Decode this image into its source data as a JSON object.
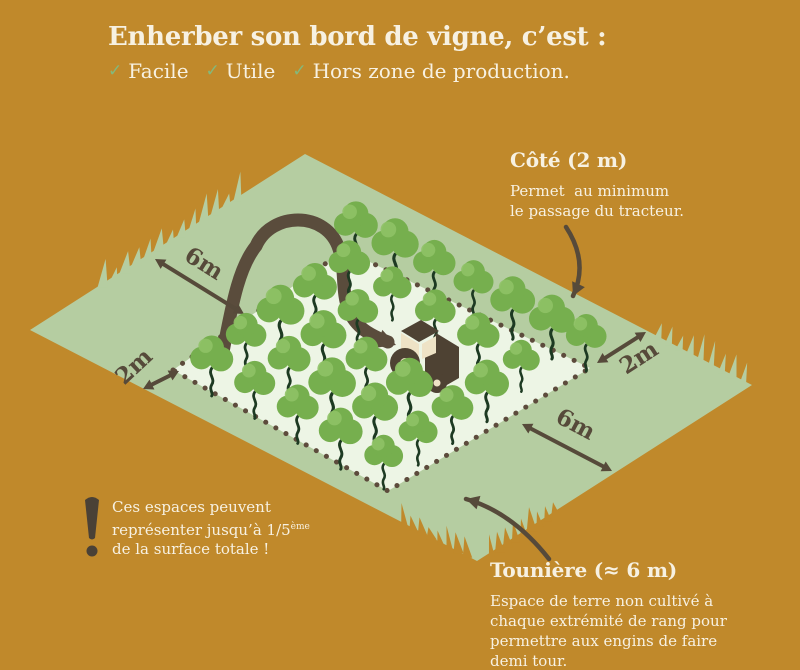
{
  "colors": {
    "background": "#c0892b",
    "grass": "#b5cda1",
    "field": "#edf5e5",
    "tree": "#76af4e",
    "tree_light": "#8fc266",
    "trunk": "#1d3a22",
    "dark": "#564a3a",
    "dots": "#5d4b3c",
    "uturn": "#5a4c3c",
    "cream": "#f7f1e2",
    "check": "#83b97c",
    "tractor_body": "#4e4233",
    "tractor_glass": "#eee3c6"
  },
  "title": {
    "text": "Enherber son bord de vigne, c’est :",
    "check_icon_char": "✓",
    "checks": [
      {
        "label": "Facile"
      },
      {
        "label": "Utile"
      },
      {
        "label": "Hors zone de production."
      }
    ]
  },
  "annotations": {
    "cote": {
      "heading": "Côté (2 m)",
      "lines": [
        "Permet  au minimum",
        "le passage du tracteur."
      ]
    },
    "touniere": {
      "heading": "Tounière (≈ 6 m)",
      "lines": [
        "Espace de terre non cultivé à",
        "chaque extrémité de rang pour",
        "permettre aux engins de faire",
        "demi tour."
      ]
    },
    "warning": {
      "line1": "Ces espaces peuvent",
      "line2_pre": "représenter jusqu’à 1/5",
      "line2_sup": "ème",
      "line3": "de la surface totale !"
    }
  },
  "measurements": [
    {
      "label": "6m",
      "x1": 155,
      "y1": 259,
      "x2": 244,
      "y2": 314,
      "lx": 200,
      "ly": 270,
      "angle": 32
    },
    {
      "label": "2m",
      "x1": 143,
      "y1": 389,
      "x2": 179,
      "y2": 371,
      "lx": 139,
      "ly": 372,
      "angle": -43
    },
    {
      "label": "2m",
      "x1": 597,
      "y1": 363,
      "x2": 646,
      "y2": 332,
      "lx": 643,
      "ly": 364,
      "angle": -33
    },
    {
      "label": "6m",
      "x1": 522,
      "y1": 424,
      "x2": 612,
      "y2": 471,
      "lx": 572,
      "ly": 431,
      "angle": 28
    }
  ],
  "diagram": {
    "outer": [
      [
        30,
        330
      ],
      [
        305,
        154
      ],
      [
        752,
        385
      ],
      [
        477,
        561
      ]
    ],
    "inner": [
      [
        173,
        370
      ],
      [
        345,
        250
      ],
      [
        590,
        368
      ],
      [
        388,
        491
      ]
    ],
    "grid": {
      "rows": 5,
      "cols": 5,
      "skip": [
        [
          3,
          2
        ],
        [
          3,
          3
        ]
      ]
    },
    "strip_trees": {
      "offset": [
        6,
        -26
      ],
      "t": [
        0.02,
        0.18,
        0.34,
        0.5,
        0.66,
        0.82,
        0.96
      ]
    },
    "grass_clusters": [
      [
        97,
        287,
        243,
        194,
        13,
        8,
        26,
        2,
        0
      ],
      [
        652,
        333,
        748,
        383,
        9,
        8,
        24,
        3,
        0
      ],
      [
        560,
        510,
        488,
        556,
        9,
        10,
        28,
        -2,
        1
      ],
      [
        472,
        556,
        400,
        520,
        8,
        8,
        20,
        -2,
        1
      ]
    ],
    "uturn_path": "M 223 352 C 233 298 240 266 256 246 C 264 228 282 220 298 220 C 316 220 333 230 339 249 C 346 270 341 292 349 311 C 356 327 369 335 388 342",
    "uturn_head": {
      "tip": [
        396,
        345
      ],
      "angle": 20
    },
    "tractor": {
      "x": 428,
      "y": 358
    },
    "curved_arrows": [
      {
        "name": "cote-arrow",
        "path": "M 566 227 Q 589 262 573 296",
        "tip": [
          573,
          296
        ],
        "angle": 115
      },
      {
        "name": "touniere-arrow",
        "path": "M 549 559 Q 512 512 466 499",
        "tip": [
          466,
          499
        ],
        "angle": 196
      }
    ],
    "exclamation": {
      "x": 92,
      "y": 500
    }
  }
}
